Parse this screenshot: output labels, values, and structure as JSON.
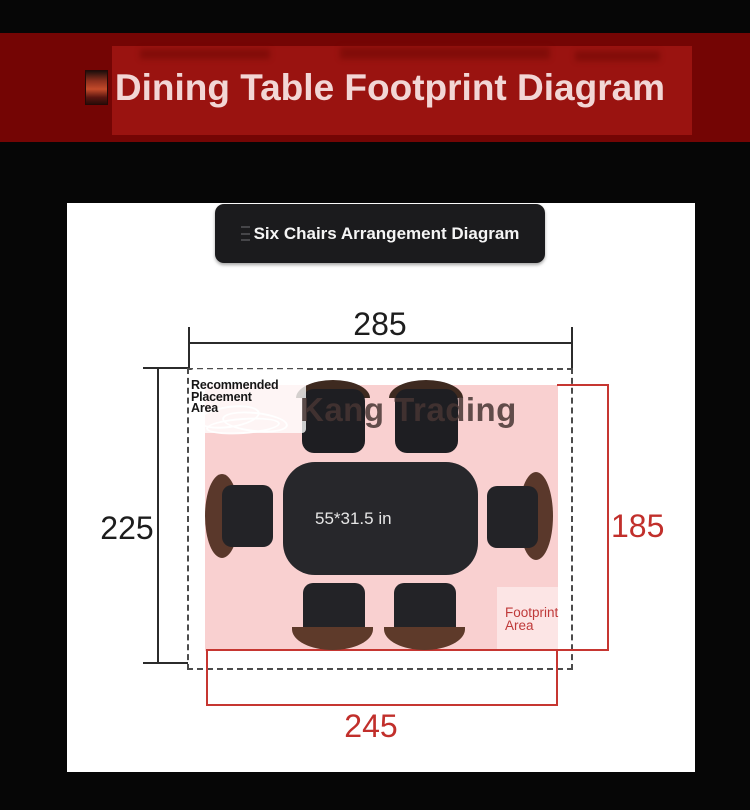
{
  "banner": {
    "title": "Dining Table Footprint Diagram",
    "bg_outer": "#740504",
    "bg_inner": "#9a1310",
    "text_color": "#f2d6d5"
  },
  "subtitle_box": {
    "label": "Six Chairs Arrangement Diagram",
    "bg": "#1b1b1d",
    "text_color": "#f5f5f5"
  },
  "diagram": {
    "dimensions": {
      "top": "285",
      "left": "225",
      "right": "185",
      "bottom": "245"
    },
    "labels": {
      "recommended_area": [
        "Recommended",
        "Placement",
        "Area"
      ],
      "footprint_area": [
        "Footprint",
        "Area"
      ],
      "table_size": "55*31.5 in",
      "watermark": "Kang Trading"
    },
    "colors": {
      "dimension_black": "#2b2b2b",
      "dimension_red": "#c63631",
      "red_text": "#c12f2b",
      "footprint_pink": "#f9d0d0",
      "chair_dark": "#232327",
      "table_dark": "#27272b",
      "wood_brown": "#5a382b",
      "dashed_border": "#4b4b4b"
    }
  }
}
